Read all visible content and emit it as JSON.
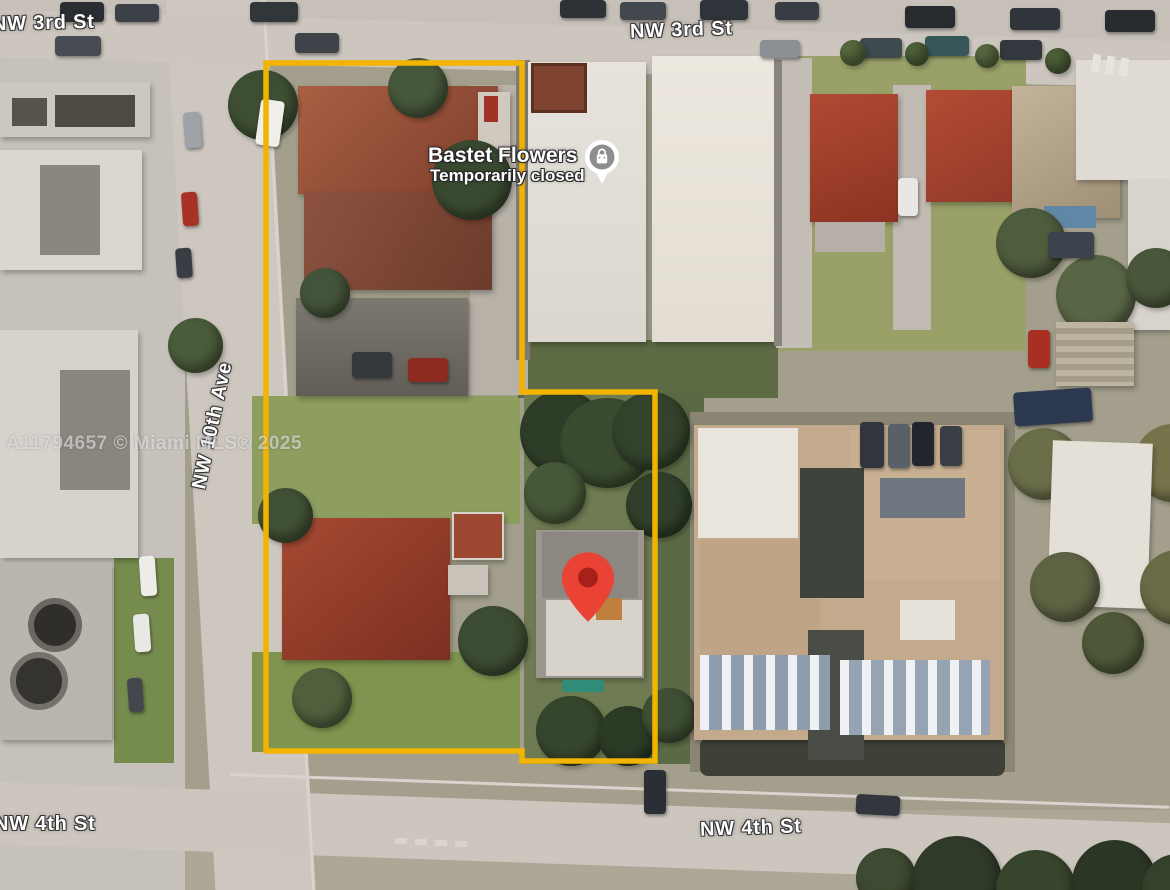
{
  "map": {
    "watermark": "A11794657 © Miami MLS® 2025",
    "streets": {
      "nw_3rd_left": "NW 3rd St",
      "nw_3rd_center": "NW 3rd St",
      "nw_10th_ave": "NW 10th Ave",
      "nw_4th_left": "NW 4th St",
      "nw_4th_center": "NW 4th St"
    },
    "poi": {
      "name": "Bastet Flowers",
      "status": "Temporarily closed",
      "icon": "closed-place-pin",
      "icon_bg": "#ffffff",
      "icon_fg": "#8e8e8e"
    },
    "marker": {
      "icon": "red-location-pin",
      "color": "#ea4335",
      "inner_color": "#a8201a"
    },
    "boundary": {
      "color": "#f3b301",
      "stroke_width": 5.5,
      "points": "266,63 522,63 522,392 655,392 655,761 522,761 522,751 266,751"
    }
  }
}
